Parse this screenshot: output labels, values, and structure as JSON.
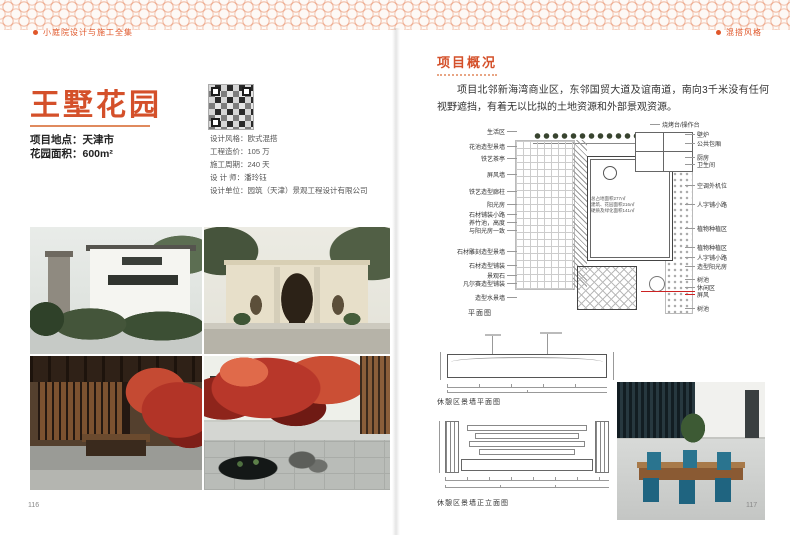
{
  "header": {
    "left": "小庭院设计与施工全集",
    "right": "混搭风格"
  },
  "footer": {
    "left_page": "116",
    "right_page": "117"
  },
  "accent_color": "#d4502a",
  "project": {
    "title": "王墅花园",
    "meta": [
      {
        "label": "项目地点：",
        "value": "天津市"
      },
      {
        "label": "花园面积：",
        "value": "600m²"
      }
    ],
    "info": [
      {
        "label": "设计风格：",
        "value": "欧式混搭"
      },
      {
        "label": "工程造价：",
        "value": "105 万"
      },
      {
        "label": "施工周期：",
        "value": "240 天"
      },
      {
        "label": "设 计 师：",
        "value": "潘玲钰"
      },
      {
        "label": "设计单位：",
        "value": "园筑（天津）景观工程设计有限公司"
      }
    ]
  },
  "overview": {
    "heading": "项目概况",
    "paragraph": "项目北邻新海湾商业区，东邻国贸大道及谊南道，南向3千米没有任何视野遮挡，有着无以比拟的土地资源和外部景观资源。"
  },
  "plan": {
    "caption": "平面图",
    "left_labels": [
      "生活区",
      "花池造型景墙",
      "铁艺茶亭",
      "屏风墙",
      "铁艺造型廊柱",
      "阳光房",
      "石材铺装小路",
      "养竹池，高度",
      "与阳光房一致",
      "石材雕刻造型景墙",
      "石材造型铺装",
      "景观石",
      "凡尔赛造型铺装",
      "造型水景墙"
    ],
    "right_labels": [
      "烧烤台/操作台",
      "壁炉",
      "公共包厢",
      "厨房",
      "卫生间",
      "空调外机位",
      "人字铺小路",
      "植物种植区",
      "植物种植区",
      "人字铺小路",
      "造型阳光房",
      "树池",
      "休闲区",
      "屏风",
      "树池"
    ],
    "notes": [
      "总占地面积277㎡",
      "建筑、花园面积216㎡",
      "硬质及绿化面积141㎡"
    ]
  },
  "drawings": {
    "plan_caption": "休憩区景墙平面图",
    "elevation_caption": "休憩区景墙正立面图"
  }
}
